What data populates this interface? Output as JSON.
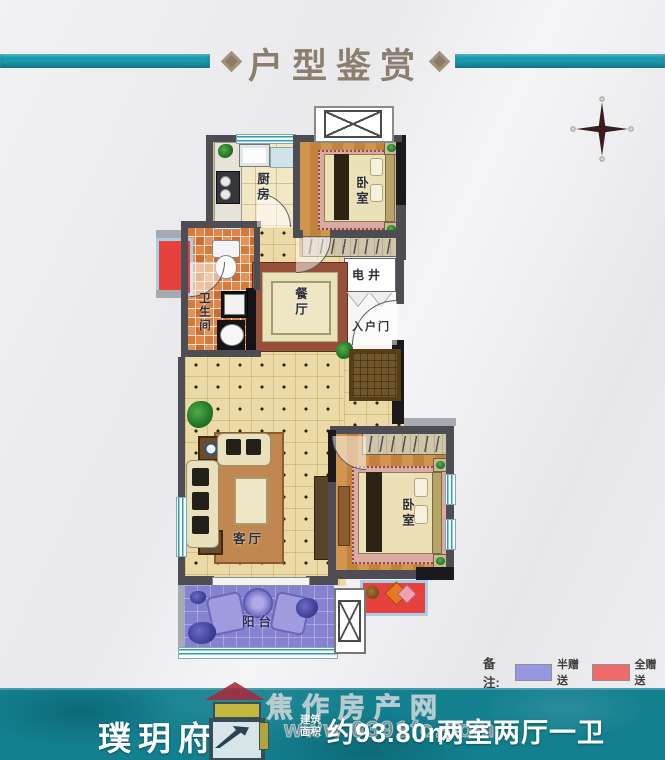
{
  "header": {
    "title": "户型鉴赏"
  },
  "compass": {
    "name": "north-compass-star"
  },
  "rooms": {
    "kitchen": "厨房",
    "bedroom_top": "卧室",
    "utility_shaft": "电井",
    "entry_door": "入户门",
    "dining": "餐厅",
    "bathroom": "卫生间",
    "living": "客厅",
    "bedroom_bottom": "卧室",
    "balcony": "阳台"
  },
  "legend": {
    "note_label": "备注:",
    "items": [
      {
        "label": "半赠送",
        "color": "#9697e0"
      },
      {
        "label": "全赠送",
        "color": "#ef6a6a"
      }
    ]
  },
  "footer": {
    "project_name": "璞玥府",
    "area_prefix_line1": "建筑",
    "area_prefix_line2": "面积",
    "area_value": "约93.80m²",
    "layout_value": "两室两厅一卫"
  },
  "watermark": {
    "site_name": "焦作房产网",
    "site_url": "www.0391fc.com"
  },
  "colors": {
    "accent_teal": "#1a9aac",
    "band_teal": "#13808f",
    "legend_half": "#9697e0",
    "legend_full": "#ef6a6a",
    "title_text": "#8b7e6f"
  }
}
